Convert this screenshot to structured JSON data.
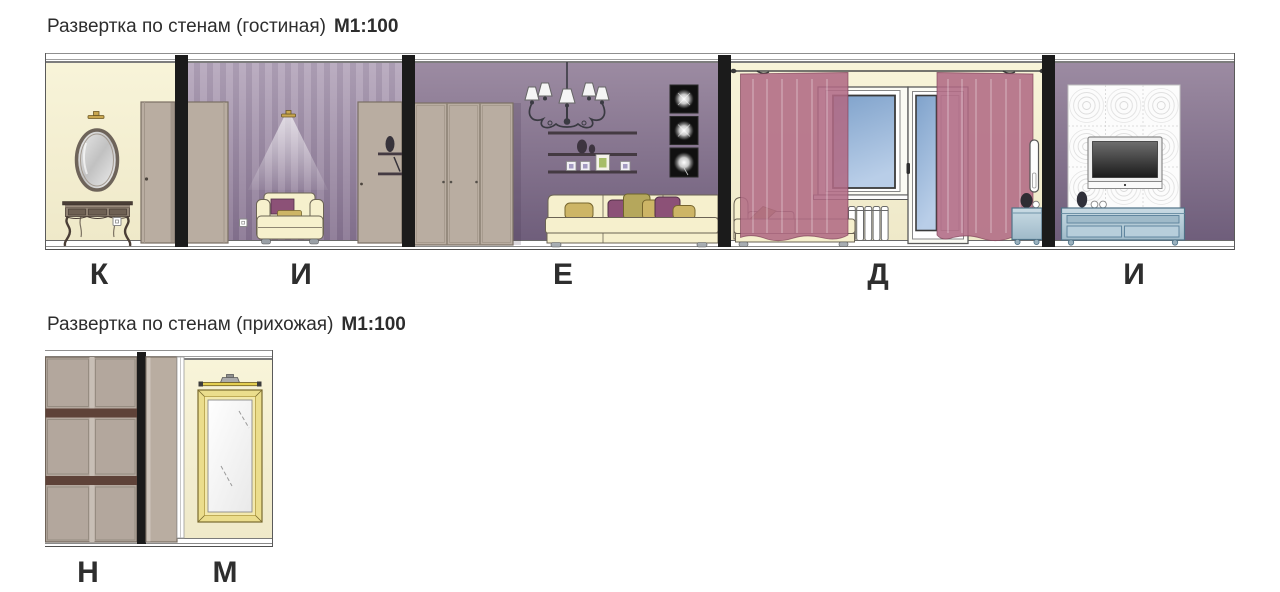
{
  "sections": {
    "living": {
      "title": "Развертка по стенам (гостиная)",
      "scale": "М1:100",
      "wall_labels": [
        "К",
        "И",
        "Е",
        "Д",
        "И"
      ]
    },
    "hall": {
      "title": "Развертка по стенам (прихожая)",
      "scale": "М1:100",
      "wall_labels": [
        "Н",
        "М"
      ]
    }
  },
  "colors": {
    "wall_cream": "#f8f4d9",
    "wall_purple_top": "#9c8ba2",
    "wall_purple_bottom": "#6f5e7b",
    "wall_stripe_light": "#a897b0",
    "wall_stripe_dark": "#93819d",
    "divider_black": "#1b1b1b",
    "furniture_taupe": "#b9ada1",
    "furniture_taupe_dark": "#7a6f64",
    "sofa_cream": "#f6f0cd",
    "cushion_mustard": "#cdb566",
    "cushion_purple": "#8c5177",
    "cushion_olive": "#b5a75c",
    "curtain_pink": "#b06a84",
    "glass_blue_top": "#7fa2cb",
    "glass_blue_bottom": "#b9cee8",
    "cabinet_blue_light": "#c9dbe4",
    "cabinet_blue": "#9fbac9",
    "cabinet_blue_dark": "#4f7287",
    "mirror_gold": "#ebdd8c",
    "lamp_gold": "#c9a750",
    "shelf_dark": "#443a42",
    "wardrobe_band_brown": "#5e4238",
    "label_text": "#2e2e2e"
  }
}
